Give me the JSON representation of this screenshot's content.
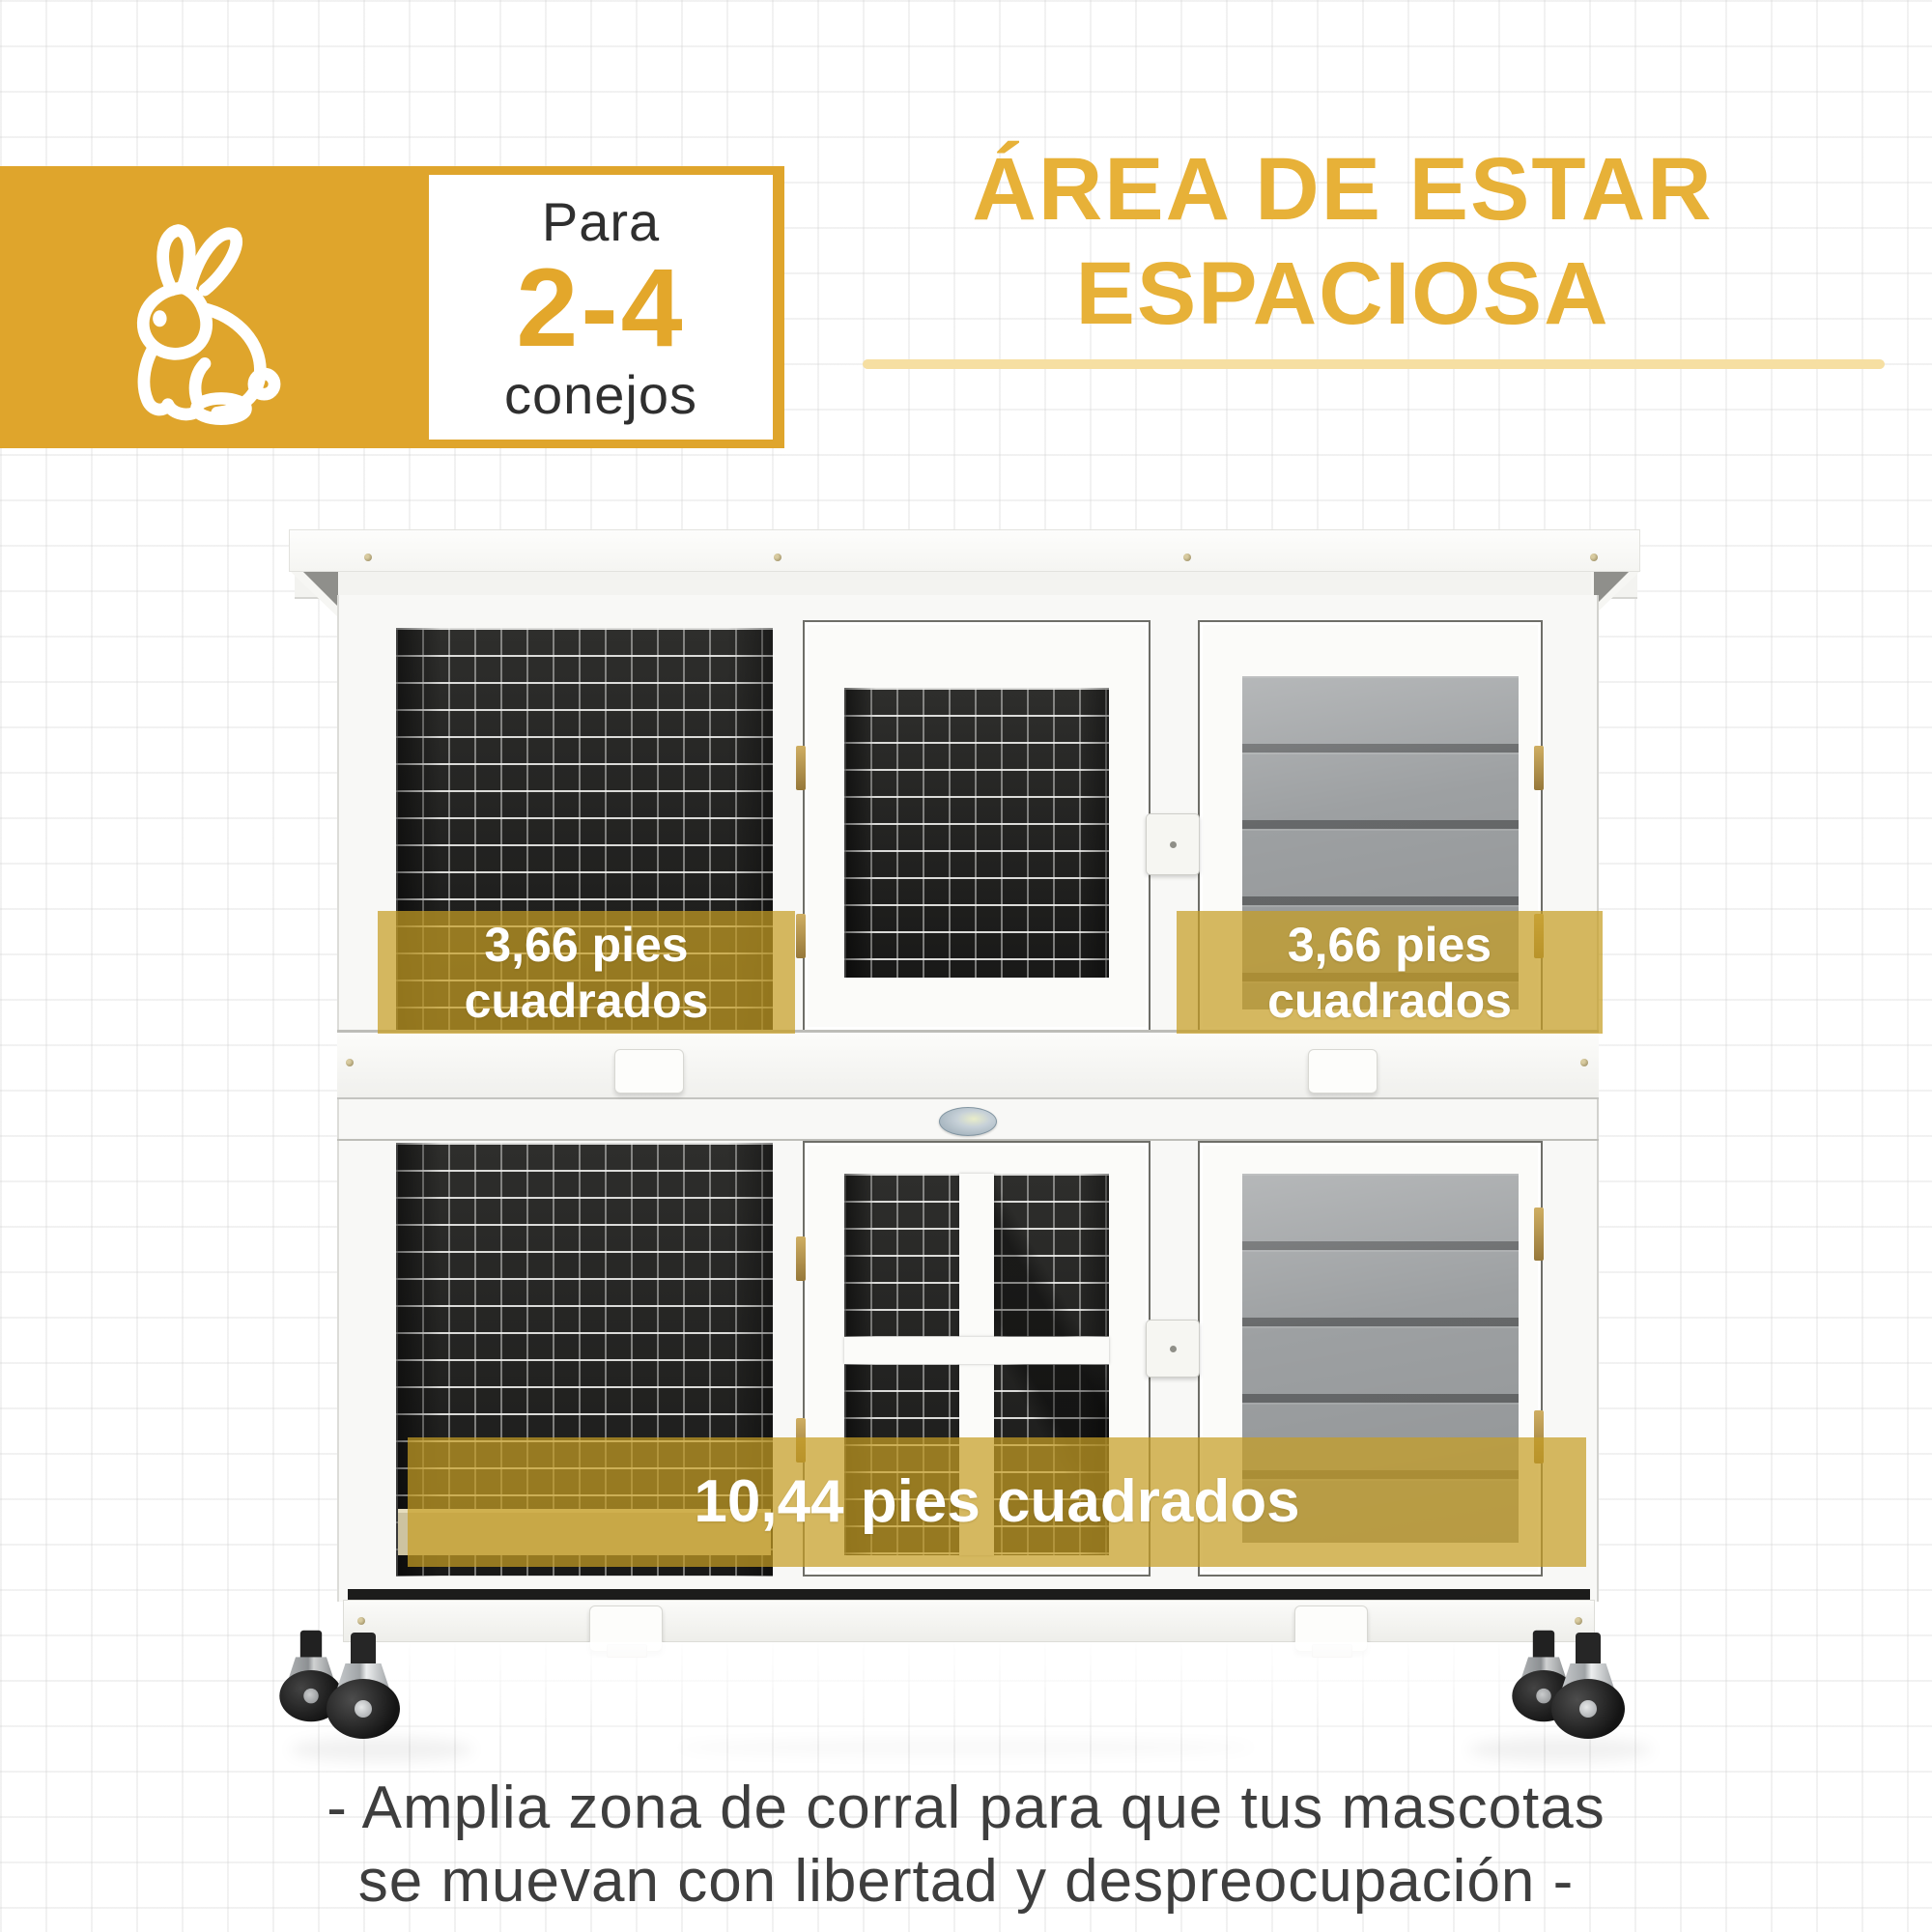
{
  "capacity_badge": {
    "prefix": "Para",
    "value": "2-4",
    "suffix": "conejos"
  },
  "headline": {
    "line1": "ÁREA DE ESTAR",
    "line2": "ESPACIOSA"
  },
  "area_labels": {
    "upper_left": {
      "line1": "3,66 pies",
      "line2": "cuadrados"
    },
    "upper_right": {
      "line1": "3,66 pies",
      "line2": "cuadrados"
    },
    "lower": {
      "text": "10,44 pies cuadrados"
    }
  },
  "caption": {
    "line1": "- Amplia zona de corral para que tus mascotas",
    "line2": "se muevan con libertad y despreocupación -"
  },
  "icons": {
    "rabbit": "rabbit-icon",
    "brand_badge": "brand-oval-badge"
  },
  "colors": {
    "accent_yellow": "#DFA52C",
    "value_yellow": "#E3A72B",
    "heading_yellow": "#E7B138",
    "underline_yellow": "#F6DFA2",
    "overlay_yellow": "rgba(198,158,36,0.72)",
    "overlay_text": "#FFFFFF",
    "caption_text": "#3E3E3E",
    "mesh_dark": "#222220",
    "slat_gray": "#9DA0A2",
    "wood_white": "#F8F8F6"
  }
}
